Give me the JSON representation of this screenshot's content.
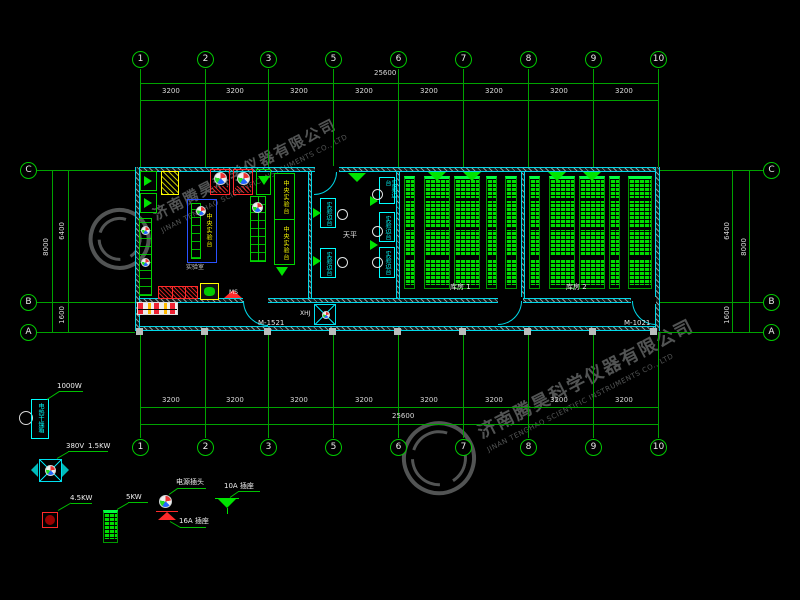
{
  "watermark": {
    "company_cn": "济南腾昊科学仪器有限公司",
    "company_en": "JINAN TENGHAO SCIENTIFIC INSTRUMENTS CO., LTD",
    "color": "#9a9f9f"
  },
  "grid": {
    "axes_h": [
      "1",
      "2",
      "3",
      "5",
      "6",
      "7",
      "8",
      "9",
      "10"
    ],
    "axes_v": [
      "C",
      "B",
      "A"
    ],
    "bays": [
      "3200",
      "3200",
      "3200",
      "3200",
      "3200",
      "3200",
      "3200",
      "3200"
    ],
    "total_width": "25600",
    "left_dims": {
      "overall": "8000",
      "c_to_b": "6400",
      "b_to_a": "1600"
    },
    "right_dims": {
      "overall": "8000",
      "c_to_b": "6400",
      "b_to_a": "1600"
    }
  },
  "plan": {
    "door_left": "M-1521",
    "door_right": "M-1021",
    "room1_label": "库房 1",
    "room2_label": "库房 2",
    "lab_label": "实验室",
    "central_bench_label": "中央实验台",
    "side_bench_label": "实验边台",
    "balance_label": "天平",
    "corridor_fan_label": "XHJ",
    "tag_ms": "MS"
  },
  "legend": {
    "oven": {
      "name": "电热干燥箱",
      "power": "1000W"
    },
    "fan": {
      "voltage": "380V",
      "power": "1.5KW"
    },
    "red_unit_power": "4.5KW",
    "rack_power": "5KW",
    "plug_label": "电源插头",
    "socket16_label": "16A 插座",
    "socket10_label": "10A 插座"
  },
  "colors": {
    "background": "#000000",
    "grid_green": "#00c000",
    "wall_cyan": "#00e5ff",
    "furniture_green": "#00e400",
    "rack_green": "#00ee00",
    "alert_red": "#ff2a2a",
    "highlight_yellow": "#ffff00",
    "bench_blue": "#2a52ff",
    "dim_text": "#d9d9d9"
  }
}
